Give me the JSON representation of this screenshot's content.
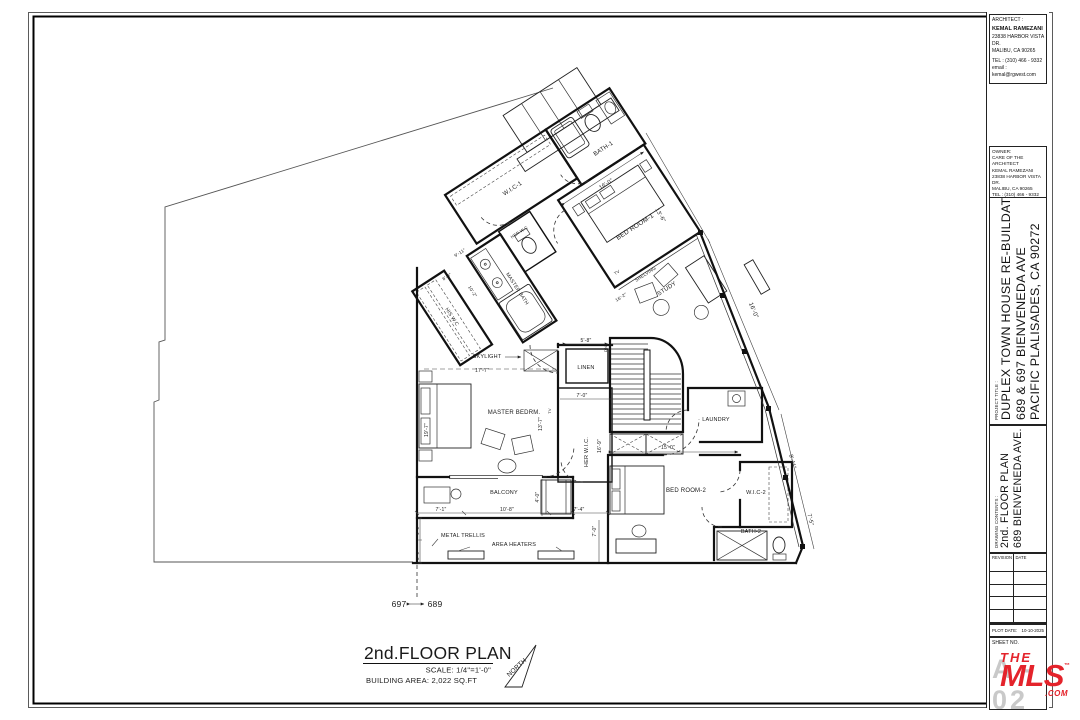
{
  "title_block": {
    "architect": {
      "heading": "ARCHITECT :",
      "name": "KEMAL RAMEZANI",
      "address1": "23838 HARBOR VISTA DR.",
      "address2": "MALIBU, CA 90265",
      "tel": "TEL : (310) 466 - 9332",
      "email": "email : kemal@rgwest.com"
    },
    "owner": {
      "heading": "OWNER:",
      "care_of": "CARE OF THE ARCHITECT",
      "name": "KEMAL RAMEZANI",
      "address1": "23838 HARBOR VISTA DR.",
      "address2": "MALIBU, CA 90265",
      "tel": "TEL :  (310) 466 - 9332",
      "email": "email : kemal@archifab.org"
    },
    "project": {
      "heading": "PROJECT TITLE :",
      "line1": "DUPLEX TOWN HOUSE RE-BUILDAT:",
      "line2": "689 & 697 BIENVENEDA AVE",
      "line3": "PACIFIC PLALISADES, CA 90272"
    },
    "contents": {
      "heading": "DRAWING CONTENTS :",
      "line1": "2nd. FLOOR PLAN",
      "line2": "689 BIENVENEDA AVE."
    },
    "revision_table": {
      "col1": "REVISION",
      "col2": "DATE"
    },
    "plot_date_label": "PLOT DATE:",
    "plot_date": "10-10-2025",
    "sheet_label": "SHEET NO.",
    "sheet_number": "A - 02",
    "logo": {
      "line1": "THE",
      "line2": "MLS",
      "tm": "™",
      "suffix": ".COM",
      "color": "#e4232b"
    }
  },
  "plan_title": {
    "title": "2nd.FLOOR PLAN",
    "scale": "SCALE: 1/4\"=1'-0\"",
    "area": "BUILDING AREA: 2,022 SQ.FT",
    "north": "NORTH"
  },
  "parcel_labels": {
    "left": "697",
    "right": "689"
  },
  "plan_labels": [
    {
      "t": "SKYLIGHT",
      "x": 487,
      "y": 358,
      "s": 5.5
    },
    {
      "t": "17'-7\"",
      "x": 482,
      "y": 372,
      "s": 5
    },
    {
      "t": "LINEN",
      "x": 586,
      "y": 369,
      "s": 5.5
    },
    {
      "t": "5'-8\"",
      "x": 586,
      "y": 342,
      "s": 5
    },
    {
      "t": "7'-0\"",
      "x": 582,
      "y": 397,
      "s": 5
    },
    {
      "t": "MASTER BEDRM.",
      "x": 514,
      "y": 414,
      "s": 6
    },
    {
      "t": "13'-7\"",
      "x": 542,
      "y": 424,
      "r": -90,
      "s": 5
    },
    {
      "t": "TV",
      "x": 551,
      "y": 411,
      "r": -90,
      "s": 4
    },
    {
      "t": "HER W.I.C.",
      "x": 588,
      "y": 452,
      "r": -90,
      "s": 5.5
    },
    {
      "t": "16'-9\"",
      "x": 601,
      "y": 446,
      "r": -90,
      "s": 5
    },
    {
      "t": "19'-7\"",
      "x": 428,
      "y": 430,
      "r": -90,
      "s": 5
    },
    {
      "t": "BALCONY",
      "x": 504,
      "y": 494,
      "s": 5.5
    },
    {
      "t": "4'-0\"",
      "x": 539,
      "y": 497,
      "r": -90,
      "s": 5
    },
    {
      "t": "7'-1\"",
      "x": 441,
      "y": 511,
      "s": 5
    },
    {
      "t": "10'-8\"",
      "x": 507,
      "y": 511,
      "s": 5
    },
    {
      "t": "7'-4\"",
      "x": 579,
      "y": 511,
      "s": 5
    },
    {
      "t": "METAL TRELLIS",
      "x": 463,
      "y": 537,
      "s": 5.5
    },
    {
      "t": "AREA HEATERS",
      "x": 514,
      "y": 546,
      "s": 5.5
    },
    {
      "t": "7'-0\"",
      "x": 596,
      "y": 531,
      "r": -90,
      "s": 5
    },
    {
      "t": "4'-0\"",
      "x": 419,
      "y": 530,
      "r": -90,
      "s": 4.5
    },
    {
      "t": "3'-0\"",
      "x": 419,
      "y": 555,
      "r": -90,
      "s": 4.5
    },
    {
      "t": "LAUNDRY",
      "x": 716,
      "y": 421,
      "s": 5.5
    },
    {
      "t": "15'-0\"",
      "x": 668,
      "y": 449,
      "s": 5
    },
    {
      "t": "BED ROOM-2",
      "x": 686,
      "y": 492,
      "s": 6
    },
    {
      "t": "W.I.C-2",
      "x": 756,
      "y": 494,
      "s": 5.5
    },
    {
      "t": "BATH-2",
      "x": 751,
      "y": 533,
      "s": 5.5
    },
    {
      "t": "16'-0\"",
      "x": 752,
      "y": 311,
      "r": 68,
      "s": 6
    },
    {
      "t": "13'-6\"",
      "x": 659,
      "y": 216,
      "r": 60,
      "s": 5.5
    },
    {
      "t": "8'-11\"",
      "x": 791,
      "y": 462,
      "r": 75,
      "s": 5.5
    },
    {
      "t": "7'-5\"",
      "x": 809,
      "y": 520,
      "r": 76,
      "s": 5.5
    },
    {
      "t": "DN",
      "x": 607,
      "y": 349,
      "r": -90,
      "s": 4
    }
  ],
  "wing_labels": [
    {
      "t": "W.I.C-1",
      "x": 580,
      "y": 265,
      "s": 6
    },
    {
      "t": "BATH-1",
      "x": 678,
      "y": 281,
      "s": 6
    },
    {
      "t": "16'-0\"",
      "x": 661,
      "y": 312,
      "s": 5.5
    },
    {
      "t": "BED ROOM-1",
      "x": 662,
      "y": 364,
      "s": 6.5
    },
    {
      "t": "HER W.C",
      "x": 562,
      "y": 305,
      "s": 4.2
    },
    {
      "t": "MASTER BATH",
      "x": 528,
      "y": 350,
      "r": 90,
      "s": 5
    },
    {
      "t": "HIS W.C",
      "x": 458,
      "y": 338,
      "r": 90,
      "s": 5
    },
    {
      "t": "9'-11\"",
      "x": 501,
      "y": 290,
      "s": 4.5
    },
    {
      "t": "8'-8\"",
      "x": 477,
      "y": 303,
      "s": 4.5
    },
    {
      "t": "10'-2\"",
      "x": 489,
      "y": 328,
      "r": 90,
      "s": 4.5
    },
    {
      "t": "TV",
      "x": 622,
      "y": 392,
      "s": 4.2
    },
    {
      "t": "SHELVING",
      "x": 645,
      "y": 409,
      "s": 4.5
    },
    {
      "t": "16'-2\"",
      "x": 612,
      "y": 415,
      "s": 4.5
    },
    {
      "t": "STUDY",
      "x": 655,
      "y": 433,
      "s": 6
    }
  ]
}
